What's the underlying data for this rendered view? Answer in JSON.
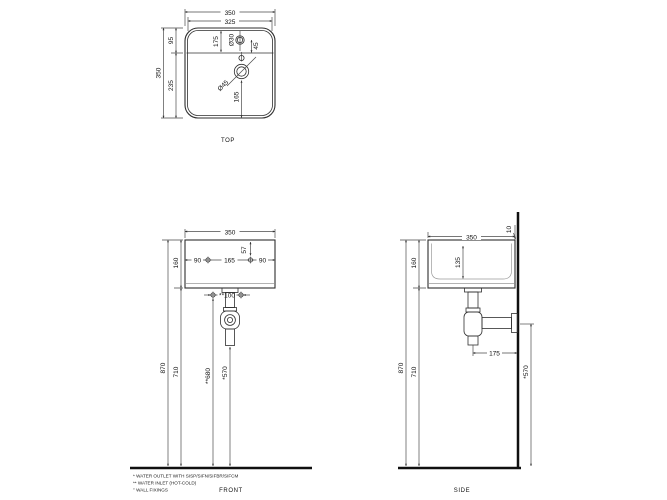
{
  "top_view": {
    "label": "TOP",
    "overall_width": "350",
    "inner_width": "325",
    "overall_depth": "350",
    "rear_section": "95",
    "front_section": "235",
    "hole_offset": "175",
    "tap_hole_dia": "Ø30",
    "tap_hole_gap": "45",
    "waste_hole_dia": "Ø45",
    "waste_to_front": "165"
  },
  "front_view": {
    "label": "FRONT",
    "width": "350",
    "height": "160",
    "fixing_left": "90",
    "fixing_center": "165",
    "fixing_right": "90",
    "fixing_depth": "57",
    "inlet_spacing": "**100",
    "rim_height": "870",
    "underside_height": "710",
    "inlet_height": "**680",
    "outlet_height": "*570"
  },
  "side_view": {
    "label": "SIDE",
    "depth": "350",
    "rear_gap": "10",
    "height": "160",
    "bowl_depth": "135",
    "outlet_to_wall": "175",
    "rim_height": "870",
    "underside_height": "710",
    "outlet_height": "*570"
  },
  "notes": [
    "* WATER OUTLET WITH SISP/SIFN/SIFBR/SIFCM",
    "** WATER INLET  (HOT-COLD)",
    "° WALL FIXINGS"
  ]
}
